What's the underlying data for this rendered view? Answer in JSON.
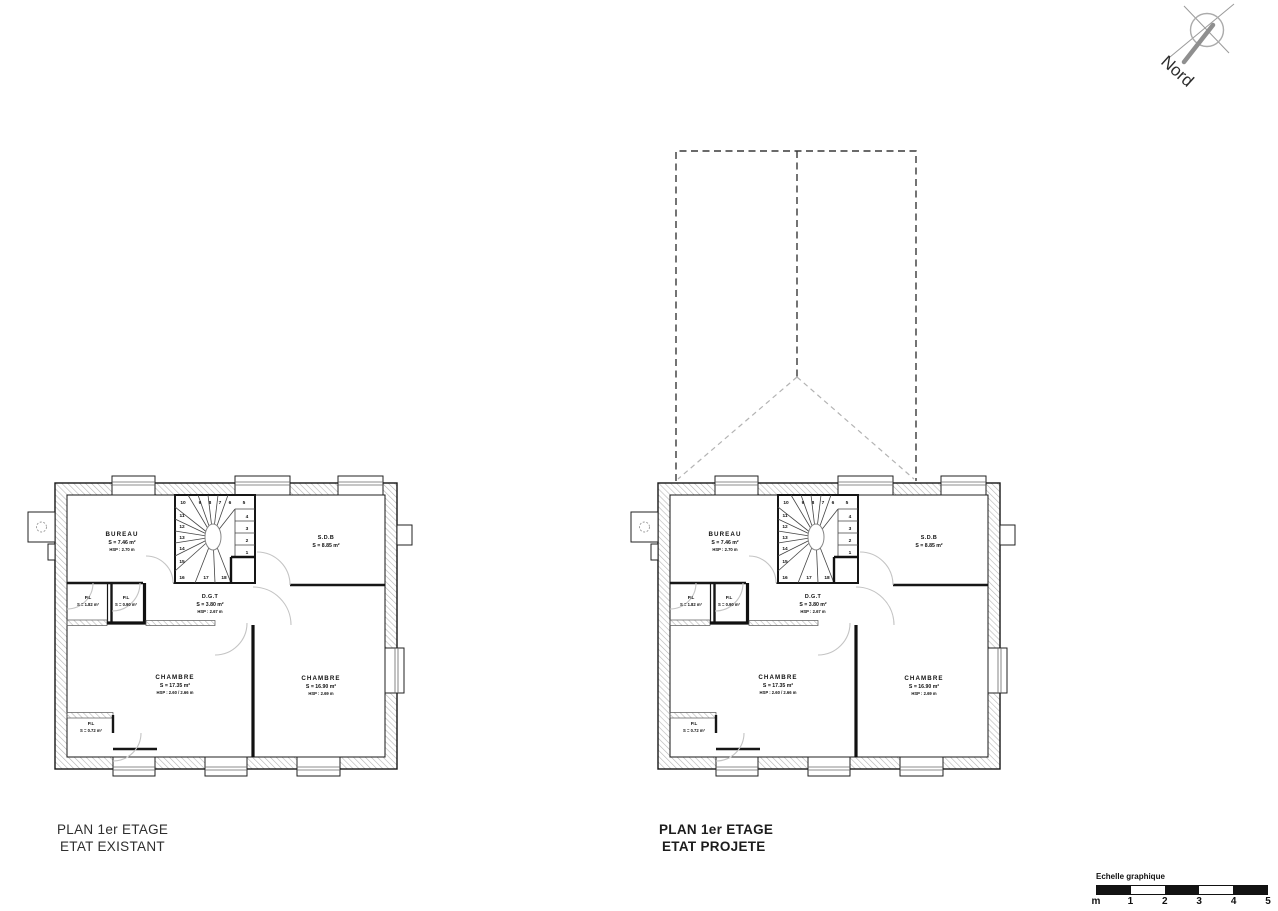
{
  "north_arrow": {
    "label": "Nord"
  },
  "rooms": {
    "bureau": {
      "name": "BUREAU",
      "area": "S = 7.46 m²",
      "height": "HSP : 2.70 m"
    },
    "sdb": {
      "name": "S.D.B",
      "area": "S = 8.85 m²"
    },
    "pl1": {
      "name": "P.L",
      "area": "S = 1.82 m²"
    },
    "pl2": {
      "name": "P.L",
      "area": "S = 0.90 m²"
    },
    "dgt": {
      "name": "D.G.T",
      "area": "S = 3.80 m²",
      "height": "HSP : 2.67 m"
    },
    "chambre_left": {
      "name": "CHAMBRE",
      "area": "S = 17.35 m²",
      "height": "HSP : 2.60 / 2.66 m"
    },
    "chambre_right": {
      "name": "CHAMBRE",
      "area": "S = 16.90 m²",
      "height": "HSP : 2.69 m"
    },
    "pl3": {
      "name": "P.L",
      "area": "S = 0.72 m²"
    }
  },
  "stairs": {
    "steps": [
      "1",
      "2",
      "3",
      "4",
      "5",
      "6",
      "7",
      "8",
      "9",
      "10",
      "11",
      "12",
      "13",
      "14",
      "15",
      "16",
      "17",
      "18"
    ]
  },
  "captions": {
    "existant": {
      "line1": "PLAN 1er ETAGE",
      "line2": "ETAT EXISTANT"
    },
    "projete": {
      "line1": "PLAN 1er ETAGE",
      "line2": "ETAT PROJETE"
    }
  },
  "scale_bar": {
    "label": "Echelle graphique",
    "ticks": [
      "m",
      "1",
      "2",
      "3",
      "4",
      "5"
    ]
  },
  "colors": {
    "wall_hatch": "#b5b5b5",
    "line": "#1a1a1a",
    "door_arc": "#c4c4c4",
    "roof_dash": "#383838",
    "roof_hip": "#b3b3b3"
  }
}
